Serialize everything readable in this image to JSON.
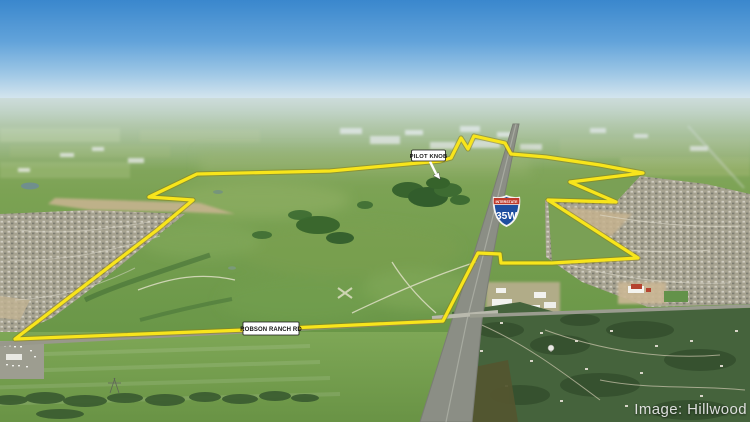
{
  "annotations": {
    "pilot_knob": {
      "label": "PILOT KNOB"
    },
    "road": {
      "label": "ROBSON RANCH RD"
    },
    "interstate_shield": {
      "top_text": "INTERSTATE",
      "route_number": "35W"
    },
    "credit": {
      "text": "Image: Hillwood"
    }
  },
  "overlay": {
    "boundary_points": "197,174 330,171 440,161 451,158 461,138 468,149 474,136 505,143 511,154 546,157 600,165 643,173 570,182 616,202 548,200 638,258 552,263 501,263 500,254 478,253 443,321 245,330 15,339 157,230 193,200 149,197 197,174",
    "boundary_color": "#f8e51b",
    "boundary_outline_color": "#8a7f12"
  },
  "scene": {
    "sky_top_color": "#3a87cd",
    "sky_horizon_color": "#dde9ef",
    "field_color": "#7aa055",
    "woodland_color": "#45633c",
    "highway_color": "#8b8e85",
    "label_bg_color": "#ffffff",
    "label_text_color": "#151515",
    "shield_blue": "#1e4fa0",
    "shield_red": "#bf3a2b",
    "credit_color": "#ebebeb"
  }
}
